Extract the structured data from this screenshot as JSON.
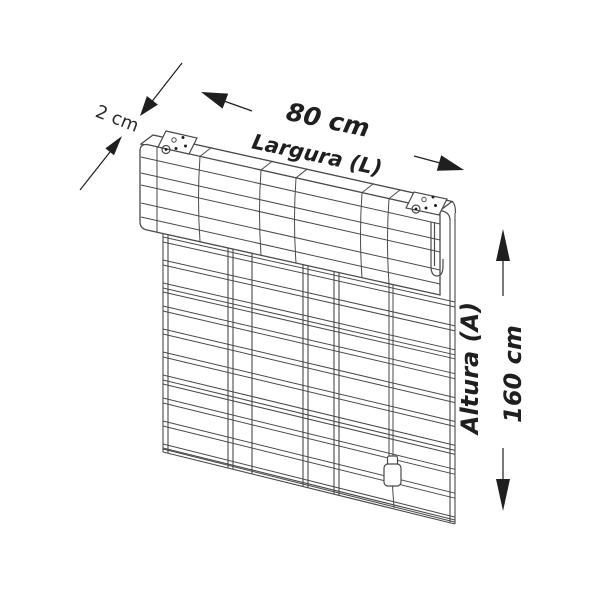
{
  "figure": {
    "type": "line-drawing-dimension-diagram",
    "subject": "roll-up blind with header rail, mounting brackets and pull cord",
    "labels": {
      "depth": "2 cm",
      "width_value": "80 cm",
      "width_name": "Largura (L)",
      "height_name": "Altura (A)",
      "height_value": "160 cm"
    },
    "colors": {
      "background": "#ffffff",
      "line": "#4a4a4a",
      "annotation": "#1f1f1f"
    }
  }
}
